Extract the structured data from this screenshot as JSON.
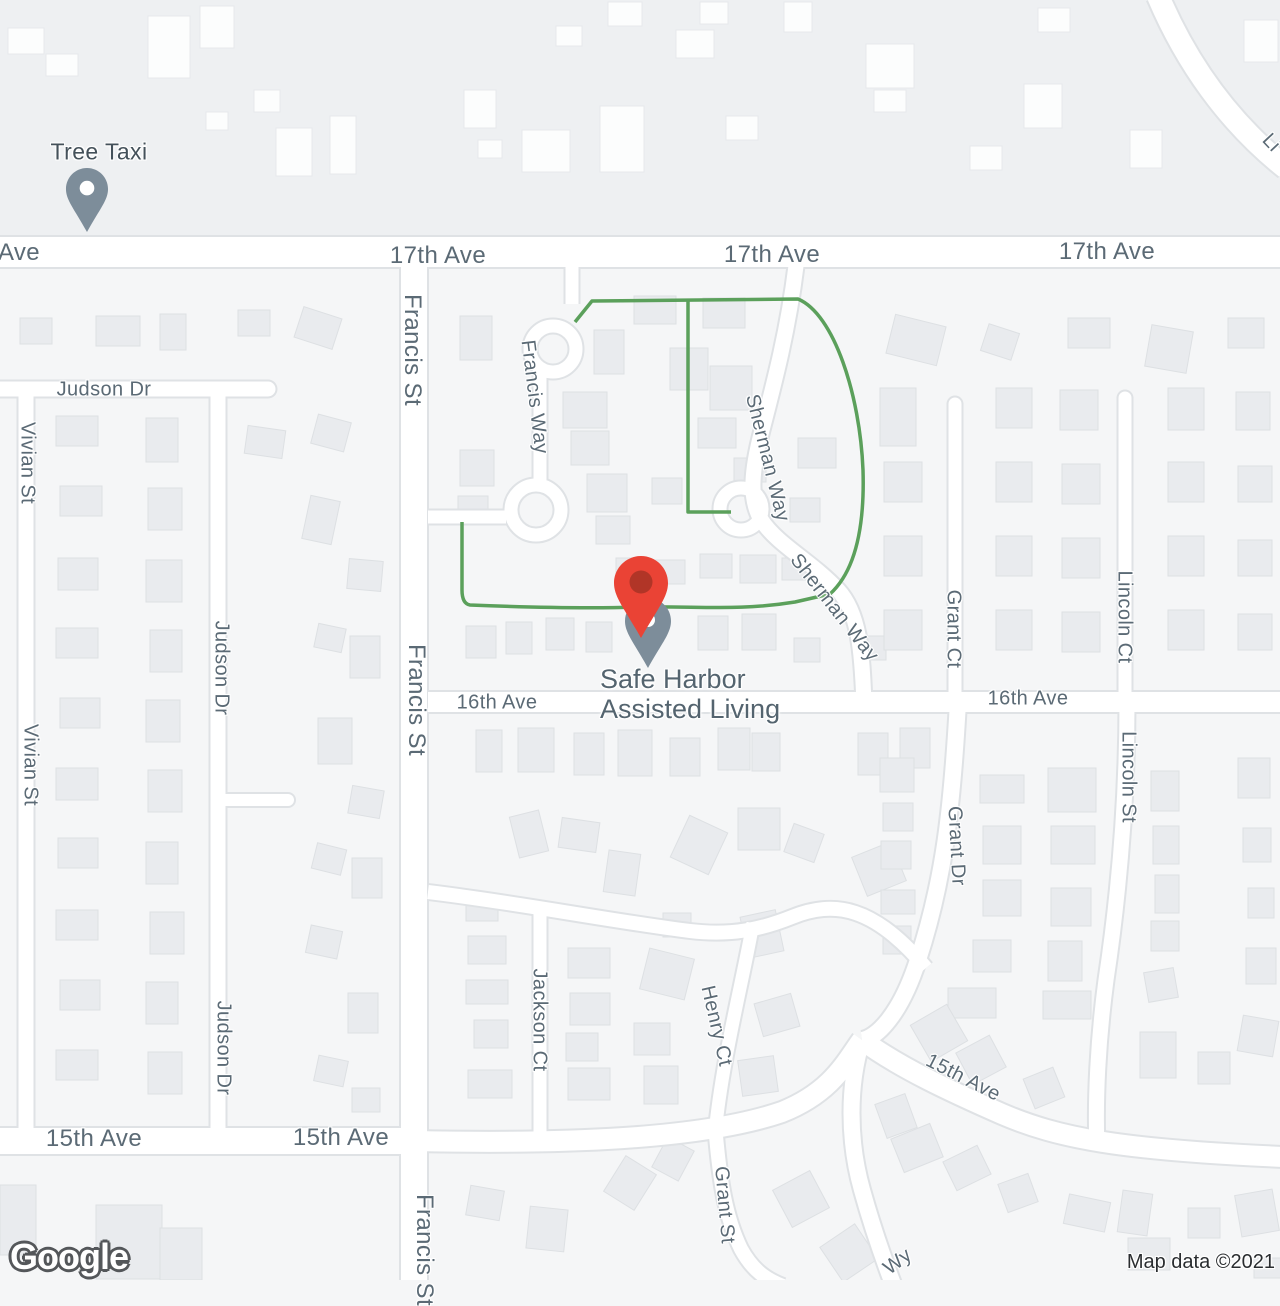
{
  "map": {
    "streets": {
      "seventeenth_ave": "17th Ave",
      "sixteenth_ave": "16th Ave",
      "fifteenth_ave": "15th Ave",
      "francis_st": "Francis St",
      "francis_way": "Francis Way",
      "sherman_way": "Sherman Way",
      "judson_dr": "Judson Dr",
      "vivian_st": "Vivian St",
      "grant_ct": "Grant Ct",
      "lincoln_ct": "Lincoln Ct",
      "lincoln_st": "Lincoln St",
      "grant_dr": "Grant Dr",
      "jackson_ct": "Jackson Ct",
      "henry_ct": "Henry Ct",
      "grant_st": "Grant St",
      "ave_partial": "Ave",
      "wy_partial": "Wy",
      "li_partial": "Li"
    },
    "place": {
      "line1": "Safe Harbor",
      "line2": "Assisted Living"
    },
    "poi": {
      "name": "Tree Taxi"
    },
    "attribution": "Map data ©2021",
    "logo": "Google",
    "colors": {
      "route_green": "#5ba05b",
      "place_pin": "#ea4335",
      "place_pin_dot": "#b13527",
      "poi_pin": "#7d8d9a",
      "road": "#ffffff",
      "road_casing": "#dfe2e5",
      "label_text": "#5b6a75",
      "background": "#f5f6f7"
    }
  }
}
